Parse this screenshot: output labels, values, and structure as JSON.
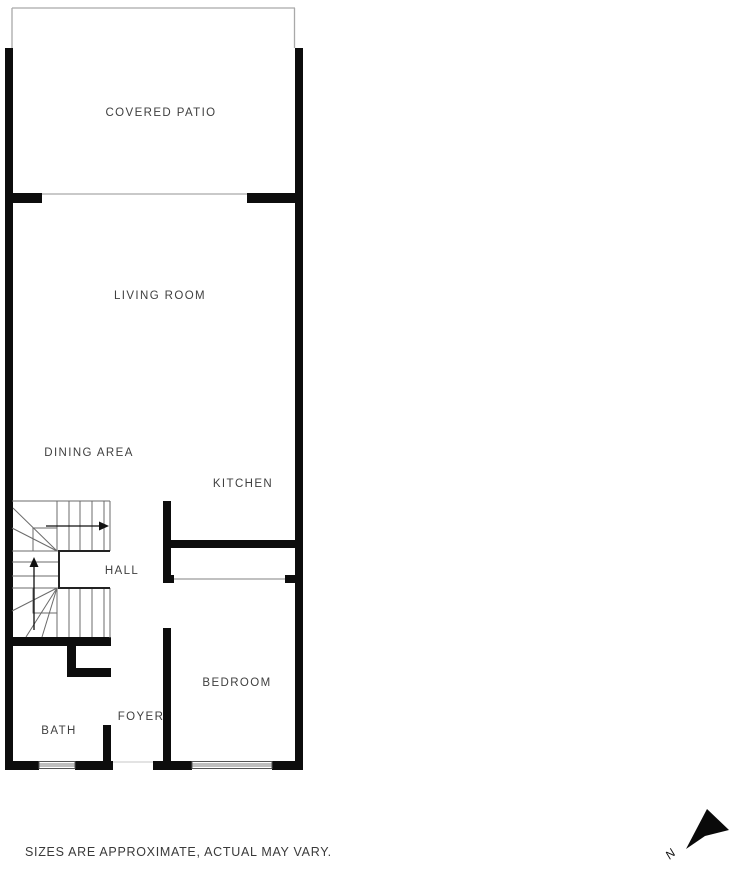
{
  "floorplan": {
    "rooms": {
      "covered_patio": "COVERED PATIO",
      "living_room": "LIVING ROOM",
      "dining_area": "DINING AREA",
      "kitchen": "KITCHEN",
      "hall": "HALL",
      "bedroom": "BEDROOM",
      "foyer": "FOYER",
      "bath": "BATH"
    }
  },
  "compass": {
    "north_label": "N",
    "icon": "north-arrow-icon"
  },
  "footer": {
    "disclaimer": "SIZES ARE APPROXIMATE, ACTUAL MAY VARY."
  },
  "colors": {
    "wall": "#0d0d0d",
    "thin_line": "#a9a9a9",
    "stair_line": "#6b6b6b",
    "stair_notch_line": "#222222",
    "label_text": "#3f3f3f",
    "background": "#ffffff"
  }
}
